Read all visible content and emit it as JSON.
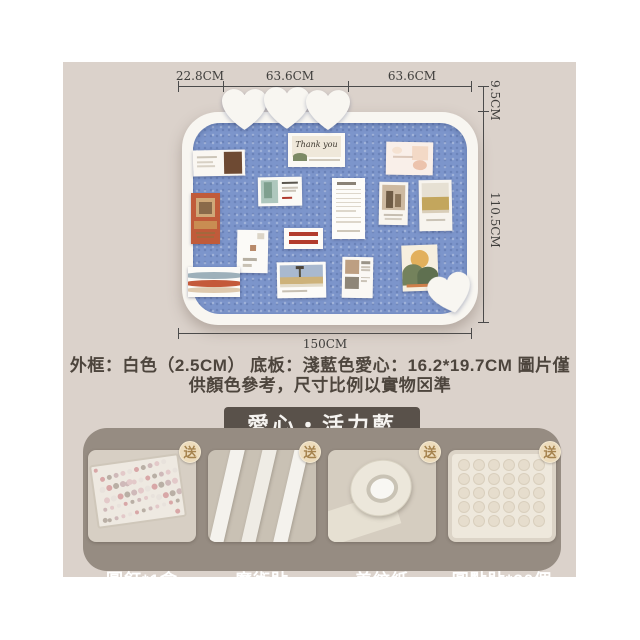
{
  "colors": {
    "content_bg": "#dbd2cb",
    "board_blue": "#7c95cb",
    "frame_white": "#f8f6f1",
    "panel_taupe": "#968c82",
    "chip_dark": "#59514a",
    "badge_cream": "#eddcbc",
    "badge_text": "#a5834e"
  },
  "dimensions": {
    "top_segments": [
      "22.8CM",
      "63.6CM",
      "63.6CM"
    ],
    "right_top": "9.5CM",
    "right_side": "110.5CM",
    "bottom_width": "150CM"
  },
  "board": {
    "thank_you_text": "Thank you",
    "hearts": [
      {
        "x": 222,
        "y": 89,
        "w": 45,
        "r": 0
      },
      {
        "x": 264,
        "y": 87,
        "w": 46,
        "r": 0
      },
      {
        "x": 306,
        "y": 90,
        "w": 44,
        "r": 0
      },
      {
        "x": 429,
        "y": 274,
        "w": 43,
        "r": -14
      }
    ],
    "cards": [
      {
        "x": 193,
        "y": 150,
        "w": 52,
        "h": 26,
        "r": -1,
        "bg": "#faf7f2",
        "blocks": [
          [
            8,
            22,
            38,
            8,
            "#ccc5b8"
          ],
          [
            8,
            42,
            30,
            7,
            "#d8d1c5"
          ],
          [
            8,
            58,
            34,
            7,
            "#d8d1c5"
          ],
          [
            60,
            8,
            34,
            84,
            "#6e4a33"
          ]
        ]
      },
      {
        "x": 288,
        "y": 133,
        "w": 57,
        "h": 34,
        "r": 0,
        "bg": "#fbf9f4",
        "text": true,
        "blocks": [
          [
            7,
            10,
            86,
            62,
            "#efe8da"
          ],
          [
            8,
            60,
            26,
            22,
            "#7c8a66",
            "50% 50% 0 0"
          ],
          [
            36,
            76,
            56,
            5,
            "#cfc8ba"
          ]
        ]
      },
      {
        "x": 386,
        "y": 142,
        "w": 47,
        "h": 33,
        "r": 1,
        "bg": "#f9efe9",
        "blocks": [
          [
            12,
            14,
            22,
            22,
            "#f5e2d2",
            "50%"
          ],
          [
            56,
            12,
            34,
            44,
            "#f3d9c6"
          ],
          [
            14,
            42,
            44,
            8,
            "#dcc8ba"
          ],
          [
            58,
            56,
            30,
            30,
            "#ecc3ad",
            "50%"
          ]
        ]
      },
      {
        "x": 191,
        "y": 193,
        "w": 29,
        "h": 51,
        "r": 0,
        "bg": "#c05b3a",
        "blocks": [
          [
            16,
            10,
            68,
            38,
            "#cfa878"
          ],
          [
            26,
            17,
            48,
            24,
            "#8a6a4a"
          ],
          [
            12,
            54,
            76,
            16,
            "#c98d52"
          ],
          [
            16,
            76,
            68,
            5,
            "#a4683c"
          ],
          [
            22,
            85,
            56,
            4,
            "#a4683c"
          ]
        ]
      },
      {
        "x": 258,
        "y": 177,
        "w": 44,
        "h": 29,
        "r": -1,
        "bg": "#fbfaf6",
        "blocks": [
          [
            6,
            10,
            40,
            80,
            "#aec7bd"
          ],
          [
            14,
            18,
            18,
            56,
            "#7fa08f"
          ],
          [
            54,
            16,
            36,
            8,
            "#5a564e"
          ],
          [
            54,
            34,
            38,
            6,
            "#cbc4b8"
          ],
          [
            54,
            46,
            32,
            6,
            "#cbc4b8"
          ],
          [
            54,
            68,
            24,
            7,
            "#b03a2e"
          ]
        ]
      },
      {
        "x": 332,
        "y": 178,
        "w": 33,
        "h": 61,
        "r": 0,
        "bg": "#fdfcf9",
        "blocks": [
          [
            14,
            6,
            58,
            5,
            "#8a8276"
          ],
          [
            12,
            18,
            76,
            2,
            "#ddd7cb"
          ],
          [
            12,
            25,
            76,
            2,
            "#ddd7cb"
          ],
          [
            12,
            32,
            76,
            2,
            "#ddd7cb"
          ],
          [
            12,
            39,
            76,
            2,
            "#ddd7cb"
          ],
          [
            12,
            46,
            76,
            2,
            "#ddd7cb"
          ],
          [
            12,
            53,
            60,
            2,
            "#ddd7cb"
          ],
          [
            12,
            64,
            76,
            2,
            "#ddd7cb"
          ],
          [
            12,
            71,
            76,
            2,
            "#ddd7cb"
          ],
          [
            14,
            86,
            70,
            3,
            "#cfc8ba"
          ]
        ]
      },
      {
        "x": 379,
        "y": 182,
        "w": 29,
        "h": 43,
        "r": 1,
        "bg": "#f8f5ef",
        "blocks": [
          [
            10,
            8,
            80,
            58,
            "#cdb9a0"
          ],
          [
            24,
            22,
            26,
            38,
            "#6e5b45"
          ],
          [
            54,
            28,
            22,
            30,
            "#8a7459"
          ],
          [
            16,
            74,
            68,
            5,
            "#c6beb1"
          ],
          [
            22,
            84,
            56,
            4,
            "#d4cdc1"
          ]
        ]
      },
      {
        "x": 419,
        "y": 180,
        "w": 33,
        "h": 51,
        "r": -1,
        "bg": "#f7f4ee",
        "blocks": [
          [
            8,
            6,
            84,
            52,
            "#e6e0d3"
          ],
          [
            8,
            34,
            84,
            26,
            "#c3a65d"
          ],
          [
            8,
            58,
            84,
            7,
            "#d9ceb9"
          ],
          [
            20,
            76,
            60,
            5,
            "#cac3b6"
          ]
        ]
      },
      {
        "x": 284,
        "y": 228,
        "w": 39,
        "h": 21,
        "r": 0,
        "bg": "#fcfaf6",
        "blocks": [
          [
            12,
            18,
            76,
            22,
            "#b23b2c"
          ],
          [
            12,
            56,
            76,
            22,
            "#b23b2c"
          ]
        ]
      },
      {
        "x": 237,
        "y": 230,
        "w": 31,
        "h": 43,
        "r": 1,
        "bg": "#fbfaf7",
        "blocks": [
          [
            66,
            8,
            22,
            14,
            "#dcd5c7"
          ],
          [
            42,
            34,
            18,
            14,
            "#b88a6a"
          ],
          [
            20,
            66,
            46,
            7,
            "#b6afa2"
          ],
          [
            20,
            80,
            30,
            5,
            "#c8c1b4"
          ]
        ]
      },
      {
        "x": 188,
        "y": 267,
        "w": 52,
        "h": 30,
        "r": 0,
        "bg": "#fbfaf7",
        "blocks": [
          [
            -10,
            18,
            120,
            22,
            "#9db0ba",
            "50%"
          ],
          [
            -10,
            42,
            120,
            24,
            "#c4593a",
            "50%"
          ],
          [
            -8,
            68,
            116,
            20,
            "#dec9ae",
            "50%"
          ]
        ]
      },
      {
        "x": 277,
        "y": 262,
        "w": 49,
        "h": 36,
        "r": -1,
        "bg": "#fcfbf8",
        "blocks": [
          [
            6,
            8,
            88,
            46,
            "#a9b9cf"
          ],
          [
            44,
            16,
            5,
            28,
            "#55503f"
          ],
          [
            38,
            10,
            18,
            10,
            "#4c443a"
          ],
          [
            6,
            42,
            88,
            20,
            "#cdb27a"
          ],
          [
            6,
            62,
            88,
            7,
            "#e2dbc9"
          ],
          [
            10,
            78,
            52,
            6,
            "#c7c0b3"
          ]
        ]
      },
      {
        "x": 342,
        "y": 257,
        "w": 31,
        "h": 41,
        "r": 1,
        "bg": "#faf8f4",
        "blocks": [
          [
            10,
            8,
            44,
            34,
            "#bd9f82"
          ],
          [
            10,
            48,
            44,
            30,
            "#8e8678"
          ],
          [
            62,
            10,
            28,
            6,
            "#9a9488"
          ],
          [
            62,
            22,
            28,
            4,
            "#cac3b7"
          ],
          [
            62,
            30,
            28,
            4,
            "#cac3b7"
          ],
          [
            62,
            48,
            28,
            4,
            "#cac3b7"
          ],
          [
            62,
            56,
            20,
            4,
            "#cac3b7"
          ]
        ]
      },
      {
        "x": 402,
        "y": 245,
        "w": 36,
        "h": 46,
        "r": -2,
        "bg": "#f6efdf",
        "blocks": [
          [
            24,
            10,
            52,
            40,
            "#e2b05c",
            "50%"
          ],
          [
            0,
            42,
            60,
            44,
            "#74825c",
            "50% 50% 0 0"
          ],
          [
            42,
            48,
            58,
            38,
            "#5f7050",
            "50% 50% 0 0"
          ],
          [
            12,
            84,
            76,
            7,
            "#cf7f4a"
          ]
        ]
      }
    ]
  },
  "description": {
    "line1": "外框：白色（2.5CM） 底板：淺藍色愛心：16.2*19.7CM 圖片僅",
    "line2": "供顏色參考，尺寸比例以實物⊠準"
  },
  "variant": {
    "label": "愛心・活力藍"
  },
  "accessories": {
    "gift_badge": "送",
    "items": [
      {
        "label": "圖釘*1盒",
        "type": "pins"
      },
      {
        "label": "魔術貼",
        "type": "strips"
      },
      {
        "label": "美紋紙",
        "type": "tape"
      },
      {
        "label": "圓點貼*30個",
        "type": "dots"
      }
    ]
  }
}
